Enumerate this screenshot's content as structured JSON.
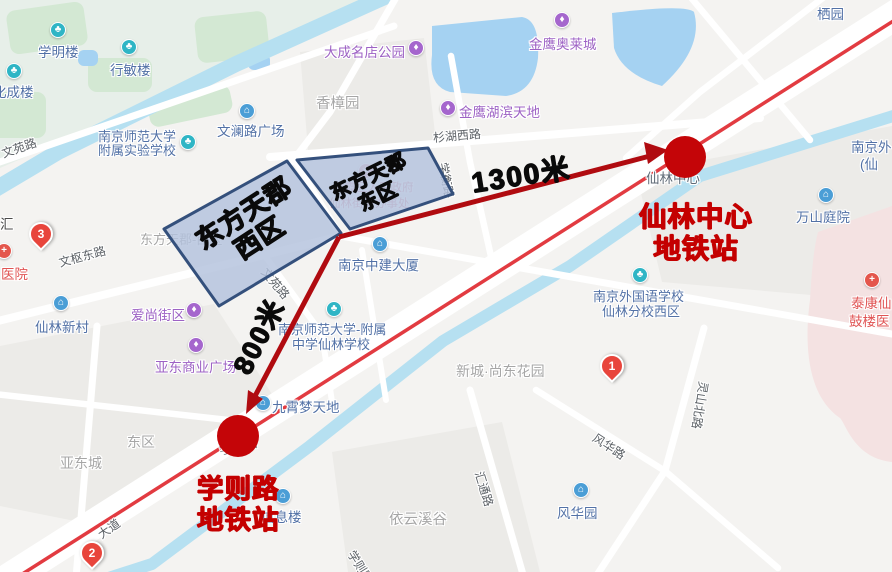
{
  "annotations": {
    "west_estate_line1": "东方天郡",
    "west_estate_line2": "西区",
    "east_estate_line1": "东方天郡",
    "east_estate_line2": "东区",
    "dist_to_xianlin_center": "1300米",
    "dist_to_xuezelu": "800米",
    "xianlin_station_line1": "仙林中心",
    "xianlin_station_line2": "地铁站",
    "xuezelu_station_line1": "学则路",
    "xuezelu_station_line2": "地铁站"
  },
  "pois": {
    "xueming": "学明楼",
    "xingmin": "行敏楼",
    "huacheng": "化成楼",
    "wenlan_plaza": "文澜路广场",
    "fushu_shiyan_1": "南京师范大学",
    "fushu_shiyan_2": "附属实验学校",
    "dacheng_park": "大成名店公园",
    "jinying_aolai": "金鹰奥莱城",
    "jinying_hubin": "金鹰湖滨天地",
    "qiyuan": "栖园",
    "njwgy_clip_1": "南京外",
    "njwgy_clip_2": "(仙",
    "wanshan": "万山庭院",
    "xianlin_center": "仙林中心",
    "gov_1": "栖霞区人民政府",
    "gov_2": "仙林街道办事处",
    "zhongjian": "南京中建大厦",
    "yiyuan": "医院",
    "hui": "汇",
    "xianlin_xincun": "仙林新村",
    "aishang": "爱尚街区",
    "yadong_plaza": "亚东商业广场",
    "nsfz_1": "南京师范大学-附属",
    "nsfz_2": "中学仙林学校",
    "jiuxiao": "九霄梦天地",
    "xinxilou": "信息楼",
    "waiguoyu_1": "南京外国语学校",
    "waiguoyu_2": "仙林分校西区",
    "fenghuayuan": "风华园",
    "taikang_1": "泰康仙",
    "taikang_2": "鼓楼医"
  },
  "areas": {
    "xiangzhang": "香樟园",
    "dftj": "东方天郡-西区",
    "dongqu": "东区",
    "yadongcheng": "亚东城",
    "yiyun": "依云溪谷",
    "xincheng": "新城·尚东花园"
  },
  "roads": {
    "wenyuan_a": "文苑路",
    "wenyuan_b": "文苑路",
    "shanhu": "杉湖西路",
    "xueheng": "学衡路",
    "wenshu": "文枢东路",
    "dadao": "大道",
    "xueze_a": "学则路",
    "xueze_b": "学则路",
    "huitong": "汇通路",
    "fenghua": "风华路",
    "lingshan": "灵山北路"
  },
  "pins": {
    "p1": "1",
    "p2": "2",
    "p3": "3"
  },
  "icons": {
    "scenic": "♣",
    "building": "⌂",
    "mall": "♦",
    "gov": "★",
    "hospital": "+"
  },
  "colors": {
    "metro_line": "#e23b41",
    "annotation_red": "#b00b10",
    "station_circle": "#c40508",
    "station_text": "#c40000",
    "estate_fill": "#b3c2dd",
    "estate_border": "#34507c",
    "water": "#a5d2f2",
    "hospital_area": "#f4e2e2"
  }
}
